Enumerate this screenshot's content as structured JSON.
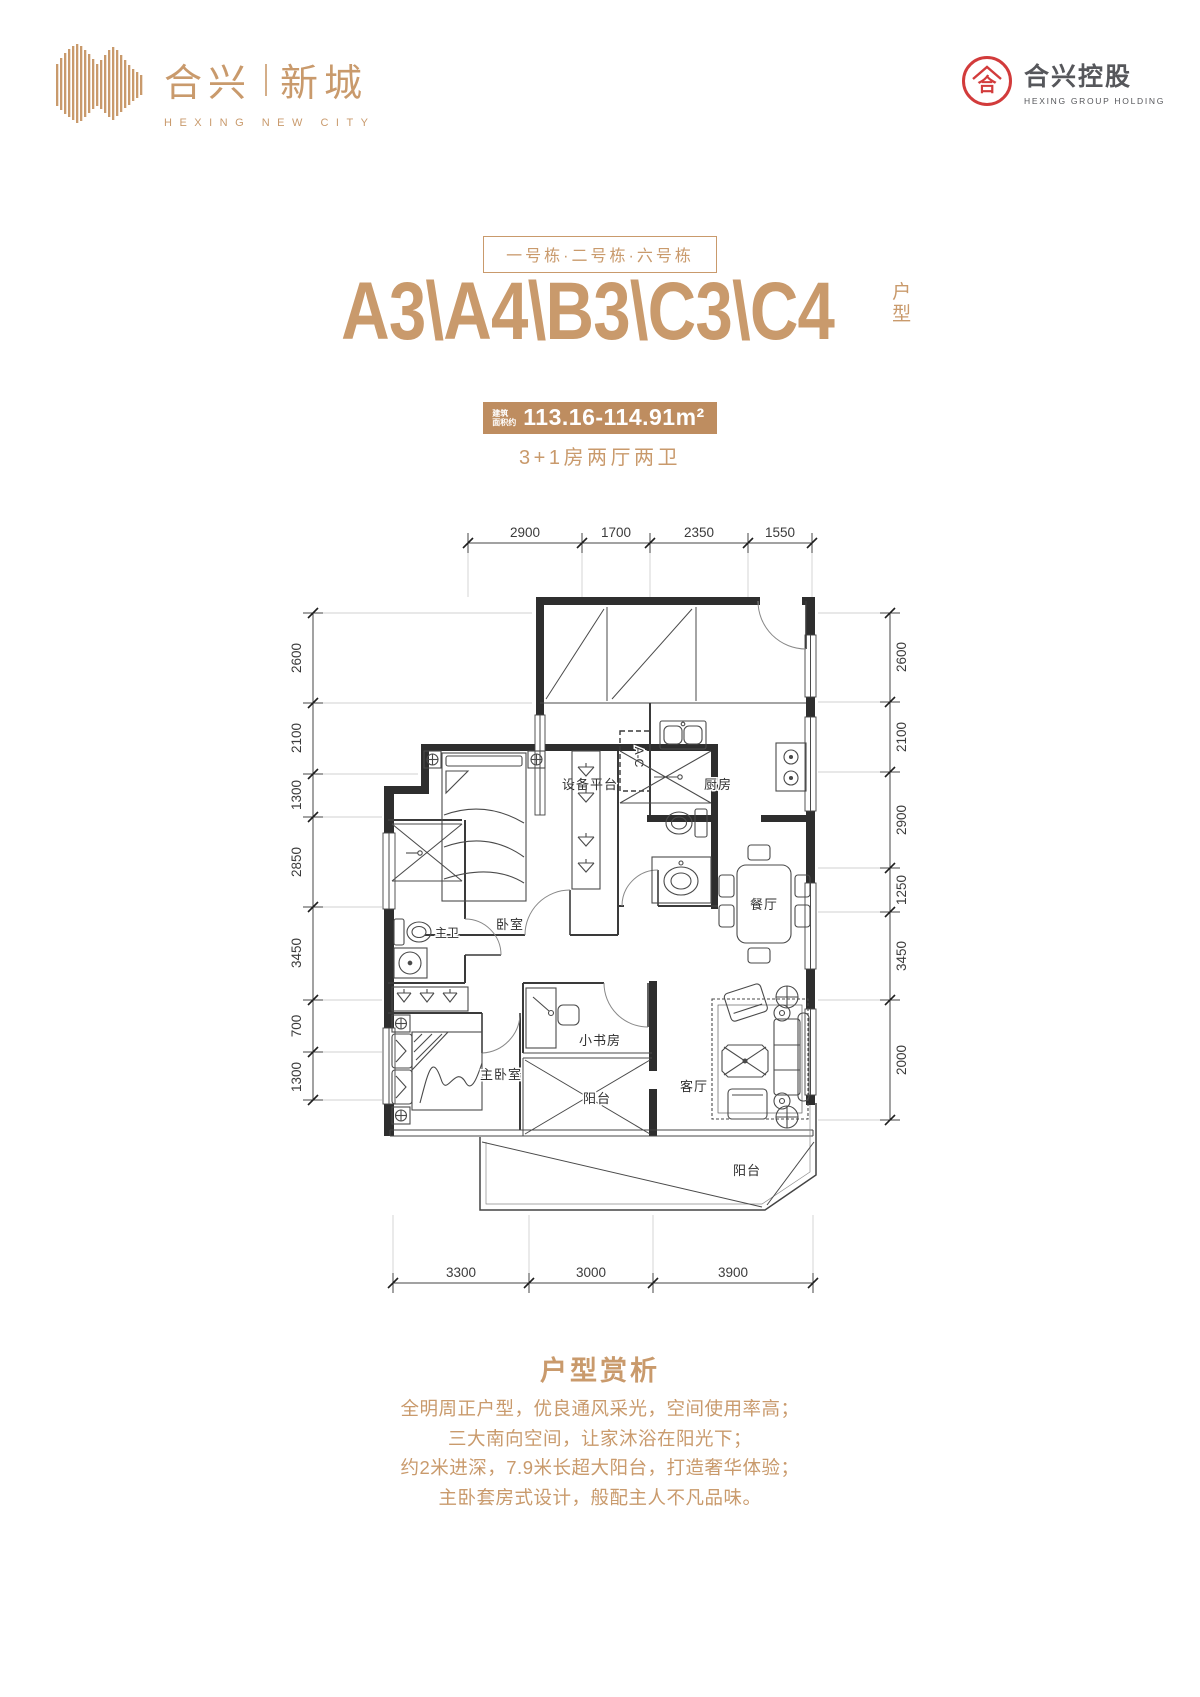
{
  "brand": {
    "name_left": "合兴",
    "name_right": "新城",
    "name_en": "HEXING NEW CITY",
    "accent": "#C99A6C"
  },
  "corp": {
    "mark": "合",
    "name": "合兴控股",
    "name_en": "HEXING GROUP HOLDING",
    "red": "#D23B3B"
  },
  "hero": {
    "buildings": "一号栋·二号栋·六号栋",
    "title": "A3\\A4\\B3\\C3\\C4",
    "title_tag": "户型",
    "area_label_1": "建筑",
    "area_label_2": "面积约",
    "area_value": "113.16-114.91m²",
    "subtitle": "3+1房两厅两卫"
  },
  "plan": {
    "dims_top": [
      "2900",
      "1700",
      "2350",
      "1550"
    ],
    "dims_left": [
      "2600",
      "2100",
      "1300",
      "2850",
      "3450",
      "700",
      "1300"
    ],
    "dims_right": [
      "2600",
      "2100",
      "2900",
      "1250",
      "3450",
      "2000"
    ],
    "dims_bottom": [
      "3300",
      "3000",
      "3900"
    ],
    "labels": {
      "equipment": "设备平台",
      "ac": "A-C",
      "kitchen": "厨房",
      "dining": "餐厅",
      "bedroom": "卧室",
      "master_bath": "主卫",
      "master_bedroom": "主卧室",
      "study": "小书房",
      "living": "客厅",
      "balcony_mid": "阳台",
      "balcony_main": "阳台"
    }
  },
  "analysis": {
    "heading": "户型赏析",
    "lines": [
      "全明周正户型，优良通风采光，空间使用率高；",
      "三大南向空间，让家沐浴在阳光下；",
      "约2米进深，7.9米长超大阳台，打造奢华体验；",
      "主卧套房式设计，般配主人不凡品味。"
    ]
  }
}
